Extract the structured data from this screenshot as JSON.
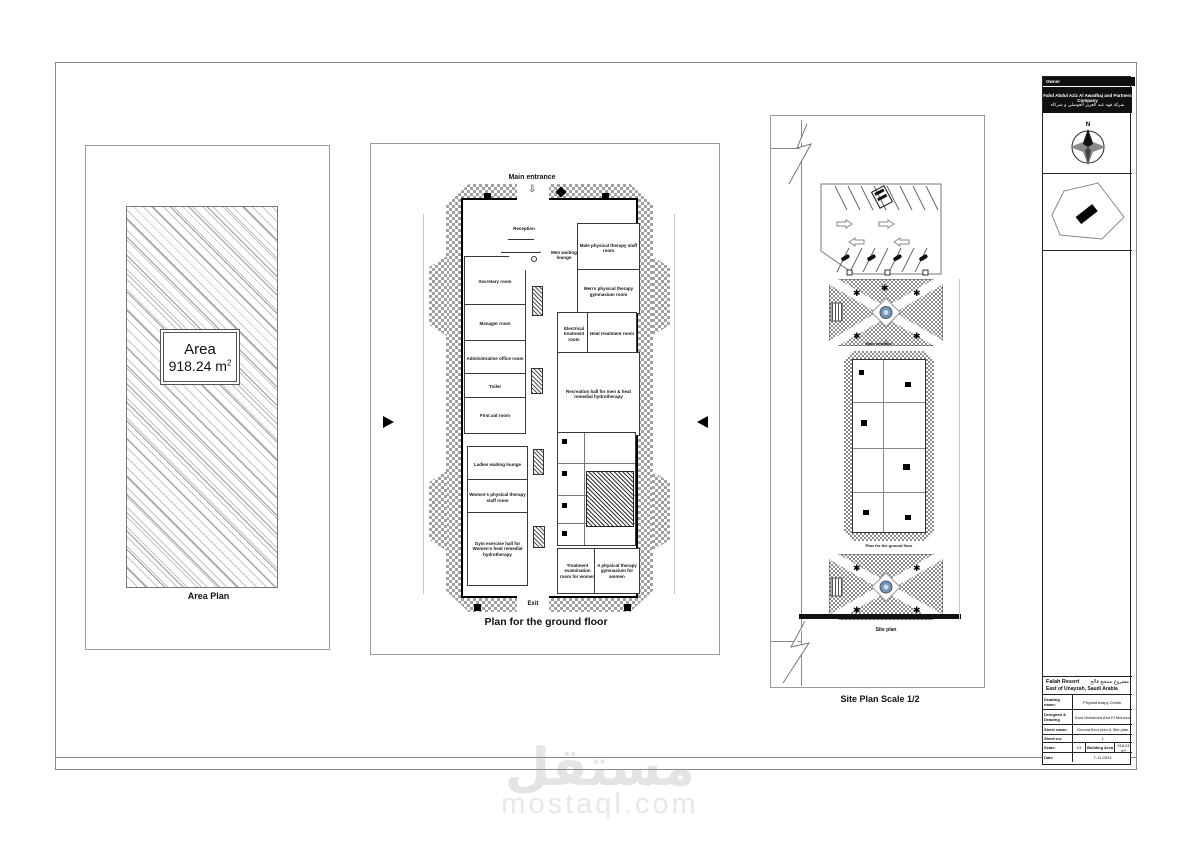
{
  "watermark": {
    "arabic": "مستقل",
    "latin": "mostaql.com"
  },
  "area_plan": {
    "caption": "Area Plan",
    "area_label": "Area",
    "area_value": "918.24 m",
    "area_sup": "2"
  },
  "ground_floor": {
    "caption": "Plan for the ground floor",
    "main_entrance_label": "Main entrance",
    "exit_label": "Exit",
    "rooms": {
      "reception": "Reception",
      "secretary": "Secretary room",
      "manager": "Manager room",
      "admin_office": "Administrative office room",
      "toilet": "Toilet",
      "first_aid": "First aid room",
      "ladies_lounge": "Ladies waiting lounge",
      "women_staff": "Women's physical therapy staff room",
      "women_hall": "Gym exercise hall for Women's heat remedial hydrotherapy",
      "male_staff": "Male physical therapy staff room",
      "men_lounge": "Men waiting lounge",
      "men_gym": "Men's physical therapy gymnasium room",
      "electrical_treatment": "Electrical treatment room",
      "heat_treatment": "Heat treatment room",
      "recreation_hall": "Recreation hall for men & heat remedial hydrotherapy",
      "women_treatment": "Treatment examination room for women",
      "women_gym": "A physical therapy gymnasium for women"
    }
  },
  "site_plan": {
    "caption": "Site Plan Scale 1/2",
    "site_label": "Site plan",
    "building_label": "Plan for the ground floor",
    "entrance_label": "Main entrance"
  },
  "title_block": {
    "owner_label": "Owner",
    "owner_name_en": "Fahd Abdul Aziz Al Awadhaj and Partners Company",
    "owner_name_ar": "شركة فهد عبد العزيز العوضلي و شركاه",
    "compass_n": "N",
    "project_name_en": "Falah Resort",
    "project_name_ar": "مشروع منتجع فالح",
    "location": "East of Unayzah, Saudi Arabia",
    "table": {
      "rows": [
        {
          "label": "Drawing name:",
          "value": "Physiotherapy Center"
        },
        {
          "label": "Designed & Drawing",
          "value": "Esra Mohamed Abd El Mohsen"
        },
        {
          "label": "Sheet name:",
          "value": "Ground floor plan & Site plan"
        },
        {
          "label": "Sheet no:",
          "value": "1"
        }
      ],
      "scale_label": "Scale:",
      "scale_value": "1/1",
      "building_area_label": "Building Area",
      "building_area_value": "918.24 m²",
      "date_label": "Date",
      "date_value": "7-11-2024"
    }
  },
  "colors": {
    "fountain": "#7695b5",
    "line": "#111111",
    "watermark": "#e4e4e4"
  }
}
